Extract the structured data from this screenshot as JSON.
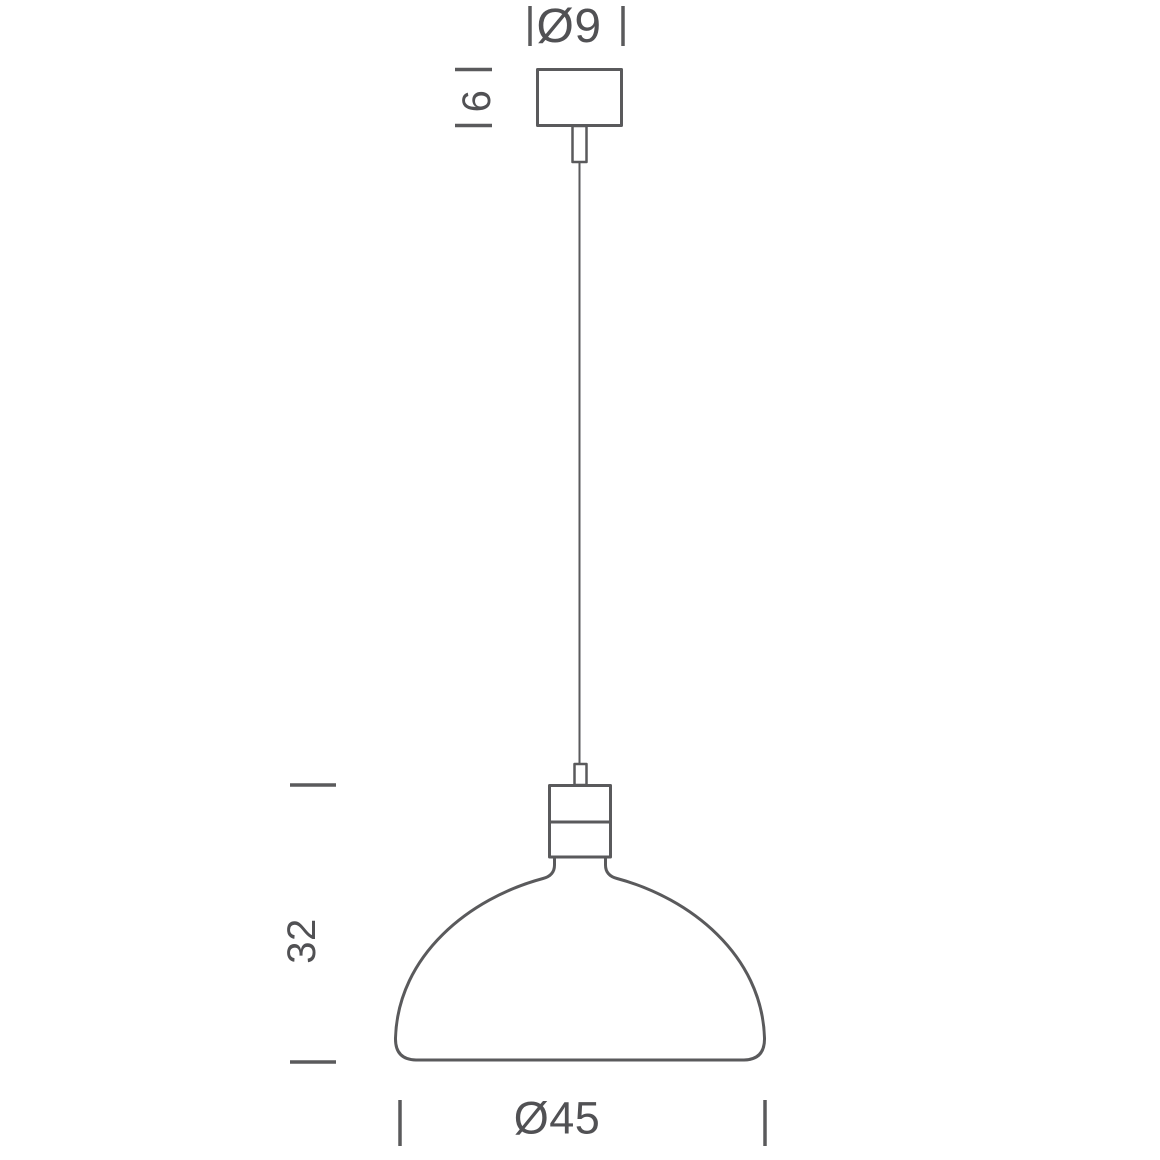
{
  "page": {
    "background": "#ffffff",
    "line_color": "#5a5a5c",
    "text_color": "#515154"
  },
  "drawing": {
    "subject": "pendant-lamp-dimension-diagram",
    "labels": {
      "canopy_diameter": "Ø9",
      "canopy_height": "6",
      "shade_height": "32",
      "shade_diameter": "Ø45"
    }
  }
}
